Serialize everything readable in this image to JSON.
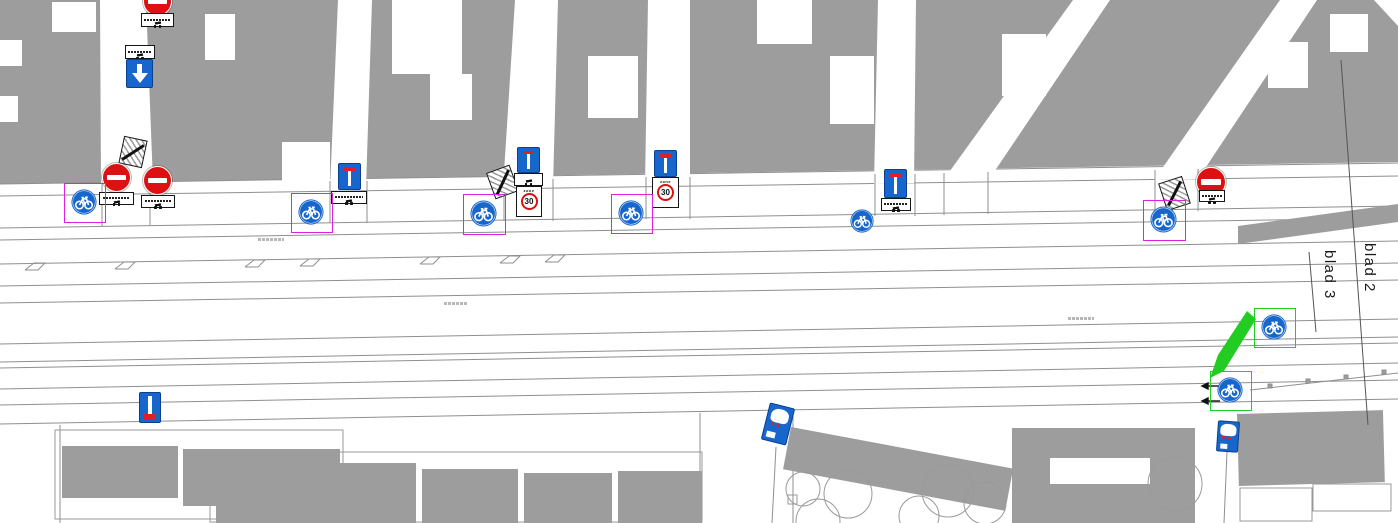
{
  "title": "Traffic-sign placement plan (cycle route), sheet 2 / sheet 3 boundary",
  "colors": {
    "sign_blue": "#1766cc",
    "sign_red": "#dd1111",
    "highlight_magenta": "#e020e0",
    "highlight_green": "#22cc22",
    "building_gray": "#9d9d9d",
    "line_gray": "#8f8f8f"
  },
  "sheet_labels": [
    {
      "text": "blad 3"
    },
    {
      "text": "blad 2"
    }
  ],
  "zone_sign": {
    "zone_text": "zone",
    "speed": "30"
  },
  "legend": {
    "no-entry": "no entry (red circle, white bar)",
    "exception-plate": "white sub-plate with bicycle/moped symbols",
    "one-way-down": "one-way traffic, follow direction (blue, white arrow)",
    "end-restrictions": "end of restrictions (white, gray hatch, black slash)",
    "dead-end": "dead-end street (blue, white stem, red bar top)",
    "dead-end-flipped": "dead-end street, reverse facing (red bar bottom)",
    "zone-30": "30 km/h zone entry",
    "cycle-path": "mandatory cycle path (blue circle, white bicycle)",
    "pictogram-blue": "small blue pictogram sign (white panel, red details)"
  },
  "signs": [
    {
      "type": "no-entry",
      "x": 143,
      "y": -13,
      "w": 29,
      "h": 29
    },
    {
      "type": "exception-plate",
      "x": 141,
      "y": 13,
      "w": 33,
      "h": 14,
      "g": 4,
      "t": true
    },
    {
      "type": "exception-plate",
      "x": 125,
      "y": 45,
      "w": 30,
      "h": 14,
      "g": 4,
      "t": true
    },
    {
      "type": "one-way-down",
      "x": 126,
      "y": 59,
      "w": 27,
      "h": 29
    },
    {
      "type": "end-restrictions",
      "x": 121,
      "y": 138,
      "w": 24,
      "h": 28,
      "rot": 12
    },
    {
      "type": "no-entry",
      "x": 102,
      "y": 163,
      "w": 29,
      "h": 29
    },
    {
      "type": "exception-plate",
      "x": 99,
      "y": 192,
      "w": 35,
      "h": 13,
      "g": 4,
      "t": true
    },
    {
      "type": "no-entry",
      "x": 143,
      "y": 166,
      "w": 29,
      "h": 29
    },
    {
      "type": "exception-plate",
      "x": 141,
      "y": 195,
      "w": 34,
      "h": 13,
      "g": 4,
      "t": true
    },
    {
      "type": "cycle-path",
      "x": 71,
      "y": 189,
      "w": 26,
      "h": 26,
      "box": "magenta"
    },
    {
      "type": "dead-end",
      "x": 338,
      "y": 163,
      "w": 23,
      "h": 27
    },
    {
      "type": "exception-plate",
      "x": 331,
      "y": 191,
      "w": 36,
      "h": 13,
      "g": 4,
      "t": true
    },
    {
      "type": "cycle-path",
      "x": 298,
      "y": 199,
      "w": 26,
      "h": 26,
      "box": "magenta"
    },
    {
      "type": "end-restrictions",
      "x": 490,
      "y": 168,
      "w": 25,
      "h": 28,
      "rot": -20
    },
    {
      "type": "dead-end",
      "x": 517,
      "y": 147,
      "w": 23,
      "h": 26
    },
    {
      "type": "exception-plate",
      "x": 514,
      "y": 173,
      "w": 29,
      "h": 13,
      "g": 4,
      "t": false
    },
    {
      "type": "zone-30",
      "x": 516,
      "y": 186,
      "w": 26,
      "h": 31
    },
    {
      "type": "cycle-path",
      "x": 470,
      "y": 200,
      "w": 27,
      "h": 27,
      "box": "magenta"
    },
    {
      "type": "dead-end",
      "x": 654,
      "y": 150,
      "w": 23,
      "h": 27
    },
    {
      "type": "zone-30",
      "x": 652,
      "y": 177,
      "w": 27,
      "h": 31
    },
    {
      "type": "cycle-path",
      "x": 618,
      "y": 200,
      "w": 26,
      "h": 26,
      "box": "magenta"
    },
    {
      "type": "dead-end",
      "x": 884,
      "y": 169,
      "w": 23,
      "h": 29
    },
    {
      "type": "exception-plate",
      "x": 881,
      "y": 198,
      "w": 30,
      "h": 13,
      "g": 4,
      "t": true
    },
    {
      "type": "cycle-path",
      "x": 850,
      "y": 209,
      "w": 24,
      "h": 24
    },
    {
      "type": "no-entry",
      "x": 1196,
      "y": 167,
      "w": 30,
      "h": 30
    },
    {
      "type": "exception-plate",
      "x": 1199,
      "y": 190,
      "w": 26,
      "h": 12,
      "g": 2,
      "t": true
    },
    {
      "type": "end-restrictions",
      "x": 1162,
      "y": 179,
      "w": 25,
      "h": 29,
      "rot": -18
    },
    {
      "type": "cycle-path",
      "x": 1150,
      "y": 206,
      "w": 27,
      "h": 27,
      "box": "magenta"
    },
    {
      "type": "cycle-path",
      "x": 1261,
      "y": 314,
      "w": 26,
      "h": 26,
      "box": "green"
    },
    {
      "type": "cycle-path",
      "x": 1217,
      "y": 377,
      "w": 26,
      "h": 26,
      "box": "green"
    },
    {
      "type": "dead-end-flipped",
      "x": 139,
      "y": 392,
      "w": 22,
      "h": 31
    },
    {
      "type": "pictogram-blue",
      "x": 765,
      "y": 405,
      "w": 26,
      "h": 38,
      "rot": 14
    },
    {
      "type": "pictogram-blue",
      "x": 1217,
      "y": 421,
      "w": 22,
      "h": 31,
      "rot": 4
    }
  ]
}
